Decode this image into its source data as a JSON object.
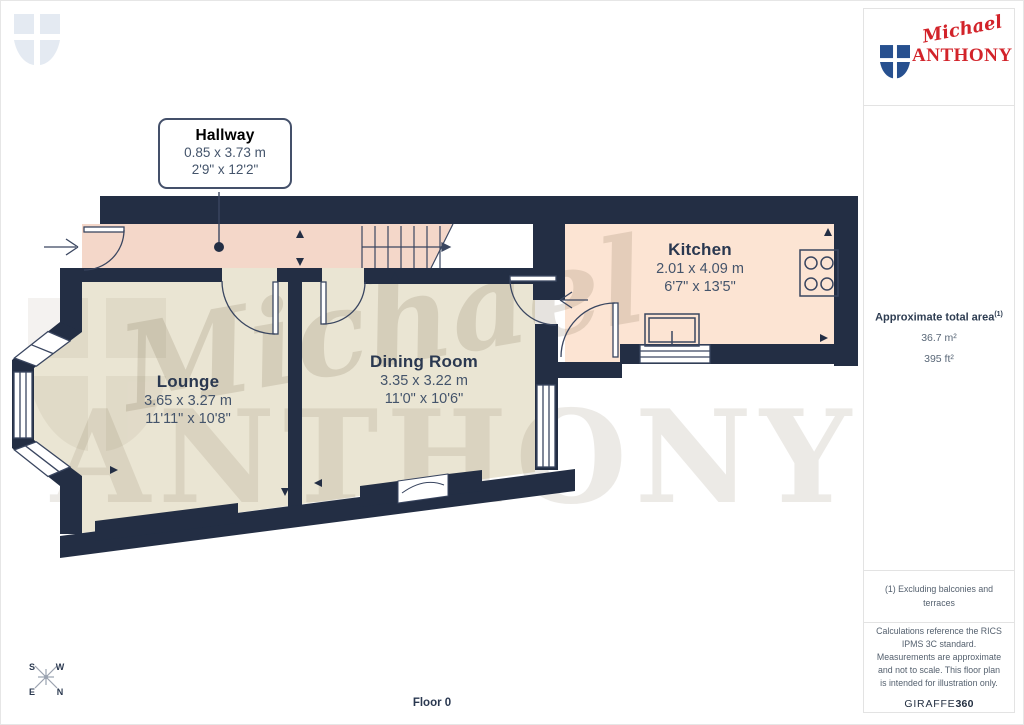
{
  "page": {
    "floor_label": "Floor 0"
  },
  "logo": {
    "script": "Michael",
    "name": "ANTHONY"
  },
  "sidebar": {
    "area_title": "Approximate total area",
    "area_sup": "(1)",
    "area_m2": "36.7 m²",
    "area_ft2": "395 ft²",
    "footnote": "(1) Excluding balconies and terraces",
    "disclaimer": "Calculations reference the RICS IPMS 3C standard. Measurements are approximate and not to scale. This floor plan is intended for illustration only.",
    "provider_name": "GIRAFFE",
    "provider_suffix": "360"
  },
  "rooms": {
    "hallway": {
      "name": "Hallway",
      "metric": "0.85 x 3.73 m",
      "imperial": "2'9\" x 12'2\""
    },
    "kitchen": {
      "name": "Kitchen",
      "metric": "2.01 x 4.09 m",
      "imperial": "6'7\" x 13'5\""
    },
    "lounge": {
      "name": "Lounge",
      "metric": "3.65 x 3.27 m",
      "imperial": "11'11\" x 10'8\""
    },
    "dining": {
      "name": "Dining Room",
      "metric": "3.35 x 3.22 m",
      "imperial": "11'0\" x 10'6\""
    }
  },
  "compass": {
    "n": "N",
    "s": "S",
    "e": "E",
    "w": "W"
  },
  "watermark": {
    "script": "Michael",
    "serif": "ANTHONY"
  },
  "colors": {
    "wall": "#232e44",
    "floor_hall": "#f4d7c9",
    "floor_kitchen": "#fce4d3",
    "floor_beige": "#eae5d3"
  }
}
